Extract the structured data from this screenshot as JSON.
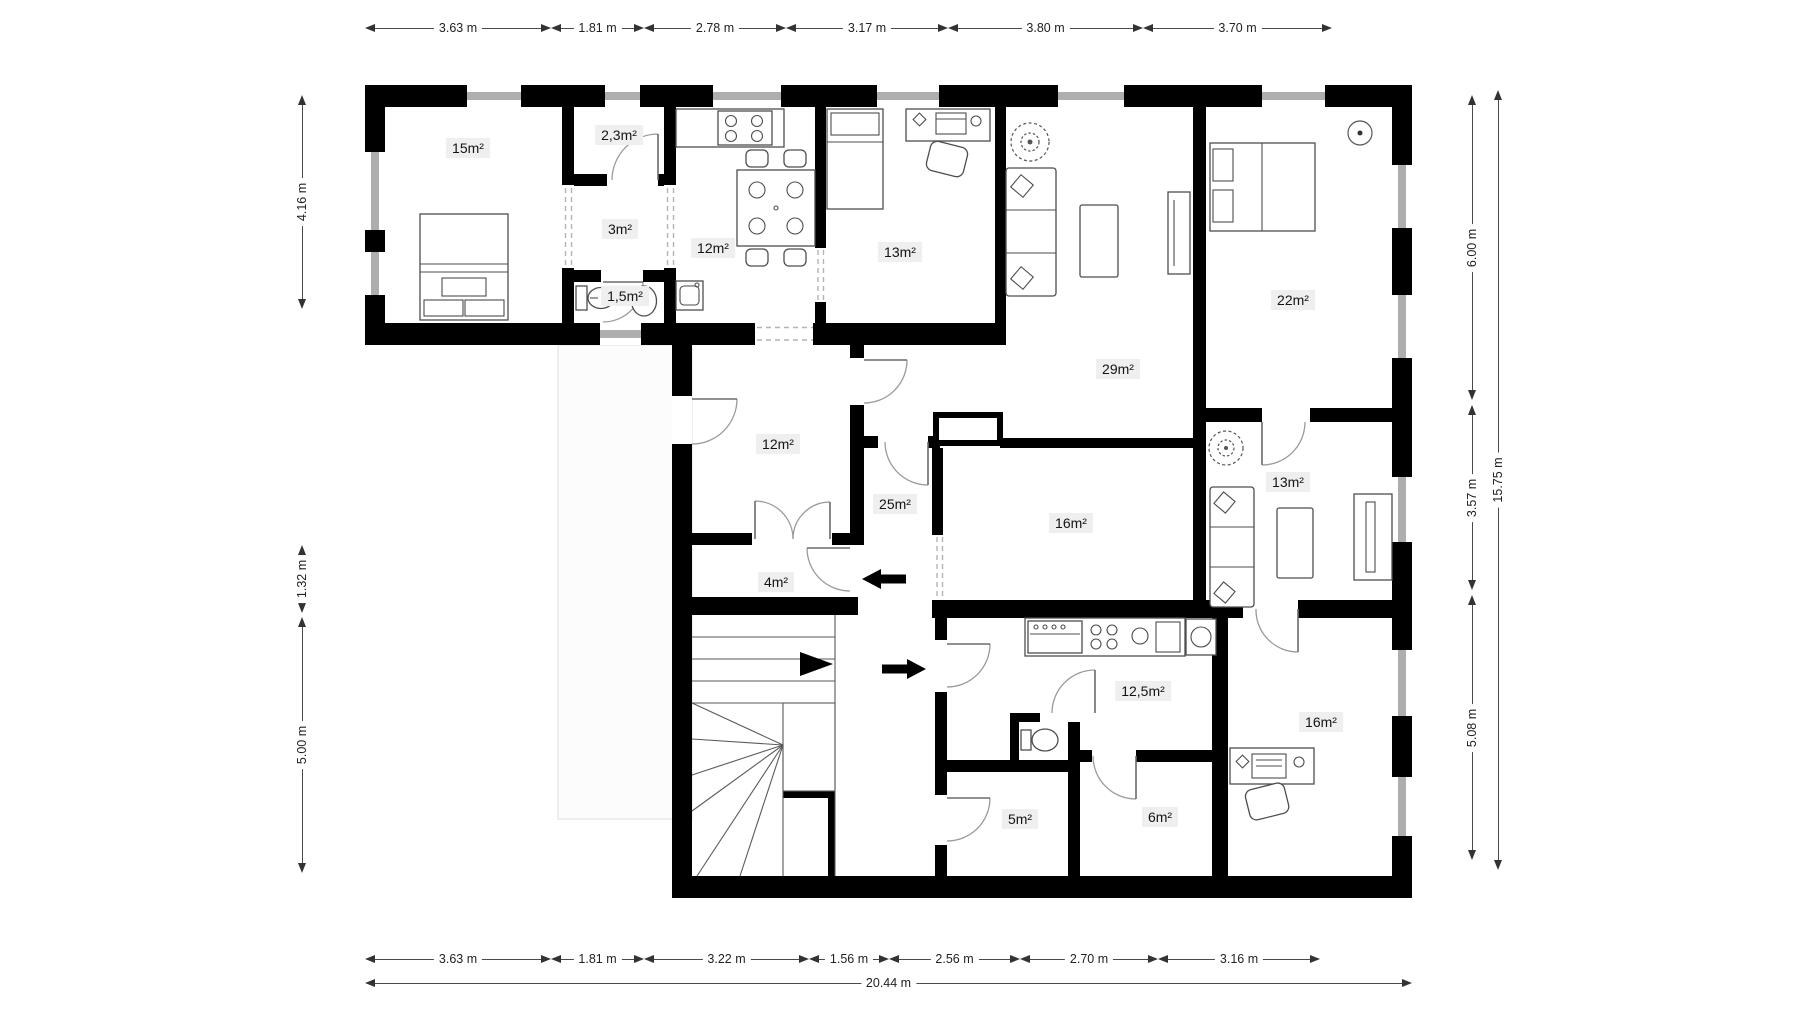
{
  "page": {
    "title": "Floor plan",
    "unit": "m"
  },
  "rooms": [
    {
      "label": "15m²",
      "x": 468,
      "y": 148
    },
    {
      "label": "2,3m²",
      "x": 619,
      "y": 135
    },
    {
      "label": "3m²",
      "x": 620,
      "y": 229
    },
    {
      "label": "12m²",
      "x": 713,
      "y": 248
    },
    {
      "label": "1,5m²",
      "x": 625,
      "y": 296
    },
    {
      "label": "13m²",
      "x": 900,
      "y": 252
    },
    {
      "label": "29m²",
      "x": 1118,
      "y": 369
    },
    {
      "label": "22m²",
      "x": 1293,
      "y": 300
    },
    {
      "label": "12m²",
      "x": 778,
      "y": 444
    },
    {
      "label": "25m²",
      "x": 895,
      "y": 504
    },
    {
      "label": "16m²",
      "x": 1071,
      "y": 523
    },
    {
      "label": "13m²",
      "x": 1288,
      "y": 482
    },
    {
      "label": "4m²",
      "x": 776,
      "y": 582
    },
    {
      "label": "12,5m²",
      "x": 1143,
      "y": 691
    },
    {
      "label": "16m²",
      "x": 1321,
      "y": 722
    },
    {
      "label": "5m²",
      "x": 1020,
      "y": 819
    },
    {
      "label": "6m²",
      "x": 1160,
      "y": 817
    }
  ],
  "dimensions": [
    {
      "orient": "h",
      "label": "3.63 m",
      "x1": 365,
      "x2": 551,
      "y": 28
    },
    {
      "orient": "h",
      "label": "1.81 m",
      "x1": 551,
      "x2": 644,
      "y": 28
    },
    {
      "orient": "h",
      "label": "2.78 m",
      "x1": 644,
      "x2": 786,
      "y": 28
    },
    {
      "orient": "h",
      "label": "3.17 m",
      "x1": 786,
      "x2": 948,
      "y": 28
    },
    {
      "orient": "h",
      "label": "3.80 m",
      "x1": 948,
      "x2": 1143,
      "y": 28
    },
    {
      "orient": "h",
      "label": "3.70 m",
      "x1": 1143,
      "x2": 1332,
      "y": 28
    },
    {
      "orient": "v",
      "label": "4.16 m",
      "x": 302,
      "y1": 95,
      "y2": 309
    },
    {
      "orient": "v",
      "label": "1.32 m",
      "x": 302,
      "y1": 545,
      "y2": 613
    },
    {
      "orient": "v",
      "label": "5.00 m",
      "x": 302,
      "y1": 617,
      "y2": 873
    },
    {
      "orient": "v",
      "label": "6.00 m",
      "x": 1472,
      "y1": 95,
      "y2": 400
    },
    {
      "orient": "v",
      "label": "3.57 m",
      "x": 1472,
      "y1": 405,
      "y2": 590
    },
    {
      "orient": "v",
      "label": "5.08 m",
      "x": 1472,
      "y1": 595,
      "y2": 860
    },
    {
      "orient": "v",
      "label": "15.75 m",
      "x": 1498,
      "y1": 90,
      "y2": 870
    },
    {
      "orient": "h",
      "label": "3.63 m",
      "x1": 365,
      "x2": 551,
      "y": 959
    },
    {
      "orient": "h",
      "label": "1.81 m",
      "x1": 551,
      "x2": 644,
      "y": 959
    },
    {
      "orient": "h",
      "label": "3.22 m",
      "x1": 644,
      "x2": 809,
      "y": 959
    },
    {
      "orient": "h",
      "label": "1.56 m",
      "x1": 809,
      "x2": 889,
      "y": 959
    },
    {
      "orient": "h",
      "label": "2.56 m",
      "x1": 889,
      "x2": 1020,
      "y": 959
    },
    {
      "orient": "h",
      "label": "2.70 m",
      "x1": 1020,
      "x2": 1158,
      "y": 959
    },
    {
      "orient": "h",
      "label": "3.16 m",
      "x1": 1158,
      "x2": 1320,
      "y": 959
    },
    {
      "orient": "h",
      "label": "20.44 m",
      "x1": 365,
      "x2": 1412,
      "y": 983
    }
  ],
  "colors": {
    "wall": "#000000",
    "window": "#aeaeae",
    "door_arc": "#9a9a9a",
    "furniture": "#4d4d4d",
    "label_background": "#efefef",
    "label_text": "#141414",
    "dimension_text": "#222222",
    "background": "#ffffff"
  }
}
